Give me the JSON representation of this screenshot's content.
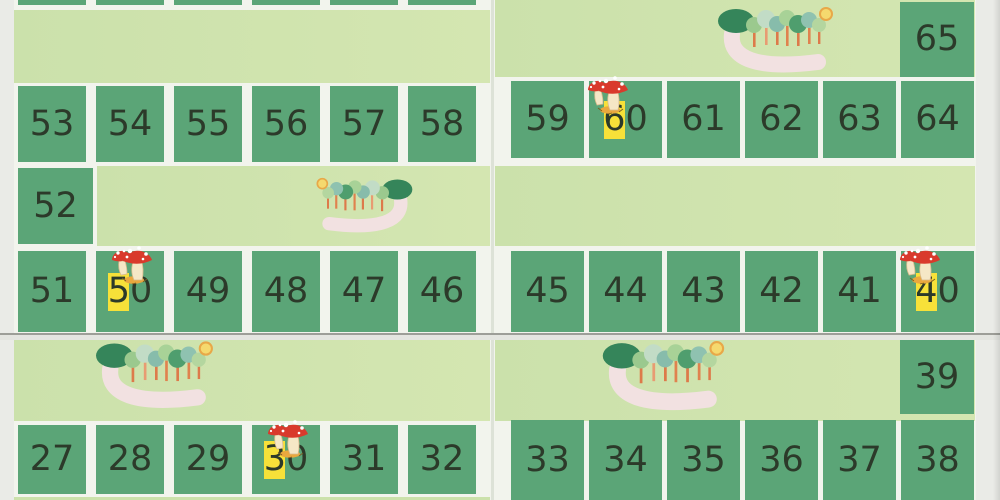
{
  "colors": {
    "square_green": "#5ba577",
    "band_green": "#cbe1ab",
    "band_green2": "#d4e6b1",
    "board_white": "#f2f4ed",
    "paper_grey": "#eaebe7",
    "highlight_yellow": "#f7e139",
    "number_ink": "#2c3a2a",
    "mushroom_red": "#d93a2c",
    "mushroom_stem": "#f5e7c6",
    "leaf_pile_orange": "#e9a83e",
    "trail_pink": "#f2e1e1",
    "sun_yellow": "#f5d96e",
    "big_tree_green": "#35855a"
  },
  "band_squares": {
    "top_right": "65",
    "middle_left": "52",
    "bottom_right": "39"
  },
  "rows": [
    {
      "id": "upper-left",
      "cells": [
        {
          "n": "53"
        },
        {
          "n": "54"
        },
        {
          "n": "55"
        },
        {
          "n": "56"
        },
        {
          "n": "57"
        },
        {
          "n": "58"
        }
      ]
    },
    {
      "id": "upper-right",
      "cells": [
        {
          "n": "59"
        },
        {
          "n": "60",
          "highlight": true,
          "mushroom": true
        },
        {
          "n": "61"
        },
        {
          "n": "62"
        },
        {
          "n": "63"
        },
        {
          "n": "64"
        }
      ]
    },
    {
      "id": "middle-left",
      "cells": [
        {
          "n": "51"
        },
        {
          "n": "50",
          "highlight": true,
          "mushroom": true
        },
        {
          "n": "49"
        },
        {
          "n": "48"
        },
        {
          "n": "47"
        },
        {
          "n": "46"
        }
      ]
    },
    {
      "id": "middle-right",
      "cells": [
        {
          "n": "45"
        },
        {
          "n": "44"
        },
        {
          "n": "43"
        },
        {
          "n": "42"
        },
        {
          "n": "41"
        },
        {
          "n": "40",
          "highlight": true,
          "mushroom": true
        }
      ]
    },
    {
      "id": "bottom-left",
      "cells": [
        {
          "n": "27"
        },
        {
          "n": "28"
        },
        {
          "n": "29"
        },
        {
          "n": "30",
          "highlight": true,
          "mushroom": true
        },
        {
          "n": "31"
        },
        {
          "n": "32"
        }
      ]
    },
    {
      "id": "bottom-right",
      "cells": [
        {
          "n": "33"
        },
        {
          "n": "34"
        },
        {
          "n": "35"
        },
        {
          "n": "36"
        },
        {
          "n": "37"
        },
        {
          "n": "38"
        }
      ]
    }
  ],
  "top_partial_row_cells": 6,
  "markers": {
    "mushroom_cells": [
      "60",
      "50",
      "40",
      "30"
    ],
    "highlight_cells": [
      "60",
      "50",
      "40",
      "30"
    ]
  },
  "illustrations": {
    "forest_scenes": 4,
    "forest_elements": [
      "trees",
      "sun",
      "pink-trail"
    ]
  }
}
